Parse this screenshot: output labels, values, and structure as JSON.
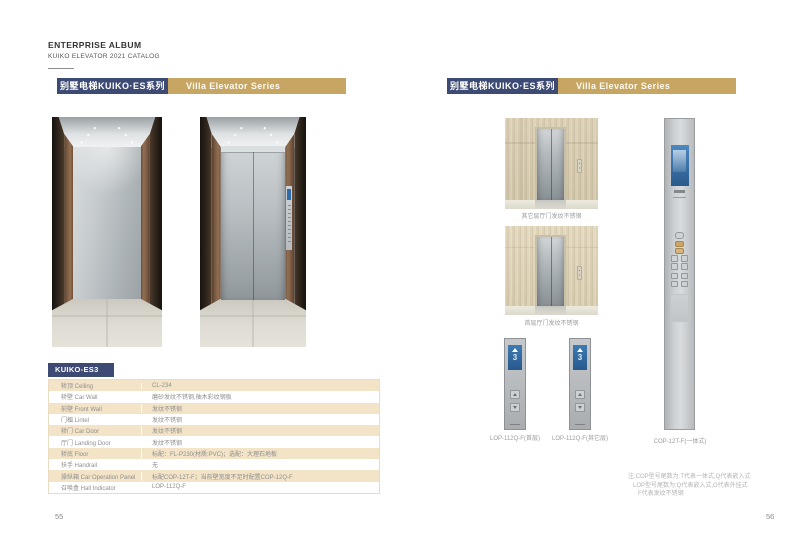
{
  "header": {
    "title": "ENTERPRISE ALBUM",
    "subtitle": "KUIKO ELEVATOR 2021 CATALOG"
  },
  "banner": {
    "title_zh": "别墅电梯KUIKO·ES系列",
    "title_en": "Villa Elevator Series"
  },
  "colors": {
    "navy": "#3d4a74",
    "gold": "#c6a662",
    "table_beige": "#f3e3c7",
    "lop_display_blue": "#2f6ea9"
  },
  "left_page": {
    "page_number": "55",
    "spec_table": {
      "model": "KUIKO-ES3",
      "rows": [
        {
          "label": "轿顶 Ceiling",
          "value": "CL-234"
        },
        {
          "label": "轿壁 Car Wall",
          "value": "磨砂发纹不锈钢,柚木彩纹钢板"
        },
        {
          "label": "前壁 Front Wall",
          "value": "发纹不锈钢"
        },
        {
          "label": "门楣 Lintel",
          "value": "发纹不锈钢"
        },
        {
          "label": "轿门 Car Door",
          "value": "发纹不锈钢"
        },
        {
          "label": "厅门 Landing Door",
          "value": "发纹不锈钢"
        },
        {
          "label": "轿底 Floor",
          "value": "标配：FL-P230(材质:PVC)；选配：大理石地板"
        },
        {
          "label": "扶手 Handrail",
          "value": "无"
        },
        {
          "label": "操纵箱 Car Operation Panel",
          "value": "标配COP-12T-F；当前壁宽度不足时配置COP-12Q-F"
        },
        {
          "label": "召唤盒 Hall Indicator",
          "value": "LOP-112Q-F"
        }
      ]
    }
  },
  "right_page": {
    "page_number": "56",
    "door_images": [
      {
        "caption": "其它层厅门发纹不锈钢"
      },
      {
        "caption": "首层厅门发纹不锈钢"
      }
    ],
    "lop_panels": [
      {
        "model_caption": "LOP-112Q-F(首层)",
        "display_floor": "3"
      },
      {
        "model_caption": "LOP-112Q-F(其它层)",
        "display_floor": "3"
      }
    ],
    "cop_panel": {
      "model_caption": "COP-12T-F(一体式)"
    },
    "notes": [
      "注:COP型号尾数为:T代表一体式,Q代表嵌入式",
      "LOP型号尾数为:Q代表嵌入式,G代表外挂式",
      "F代表发纹不锈钢"
    ]
  }
}
